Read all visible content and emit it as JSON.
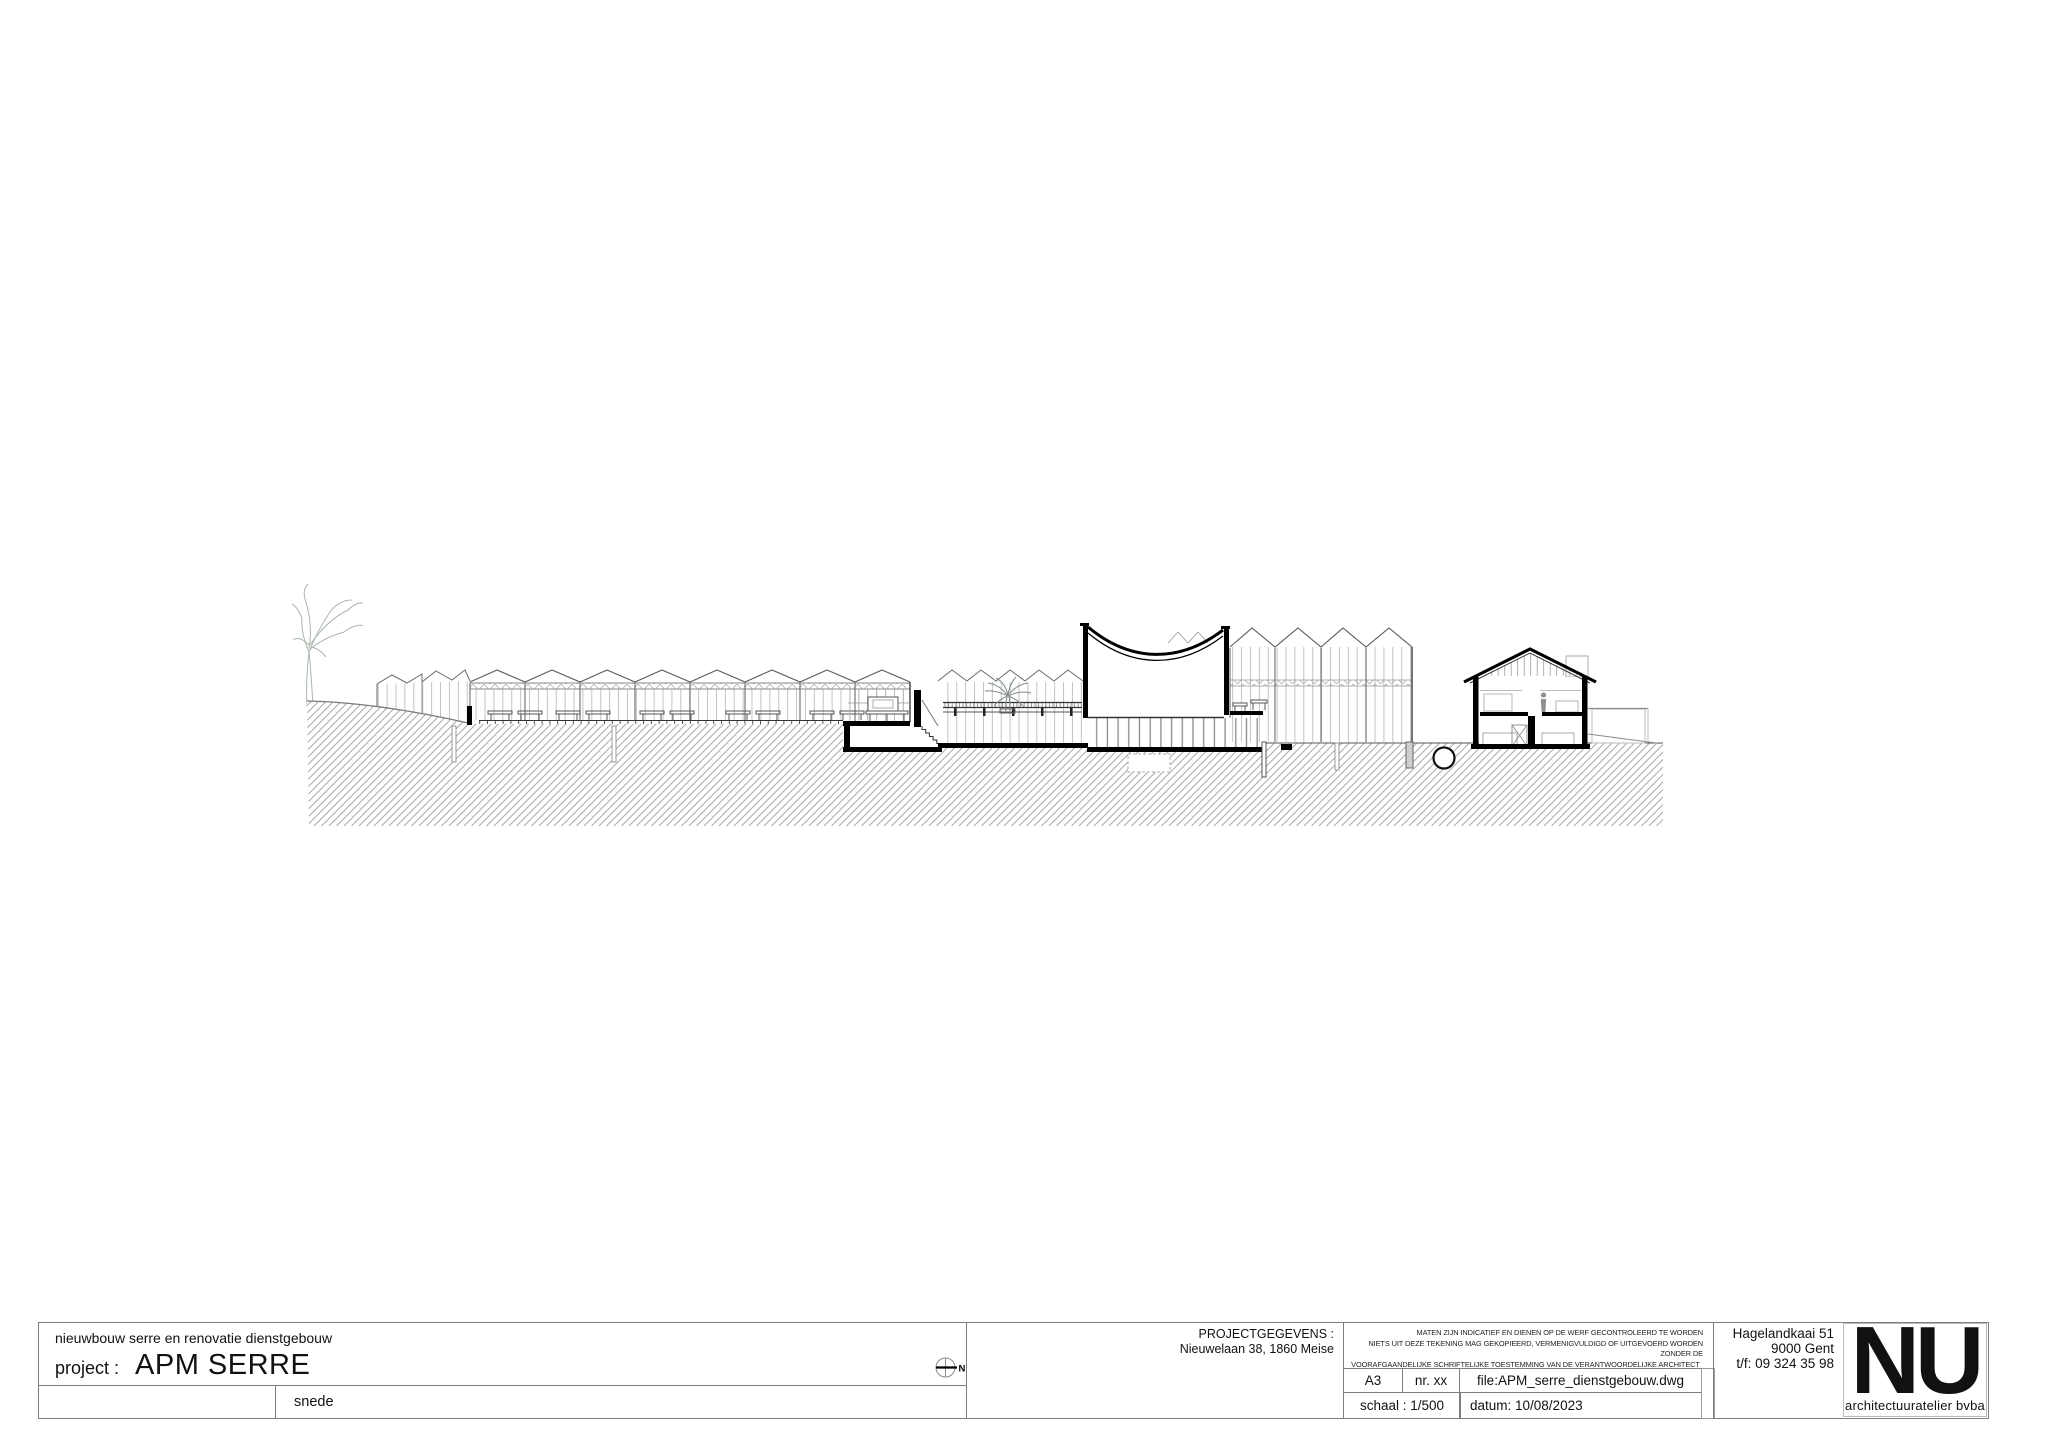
{
  "page": {
    "width": 2048,
    "height": 1448,
    "background": "#ffffff"
  },
  "drawing": {
    "kind": "architectural-section",
    "colors": {
      "cut_line": "#000000",
      "structure_line": "#6b6b6b",
      "glazing_line": "#b4b4b4",
      "hatch_line": "#9b9b9b",
      "tree": "#a9b7ad",
      "palm": "#7e8f84"
    }
  },
  "title_block": {
    "project_description": "nieuwbouw serre en renovatie dienstgebouw",
    "project_label": "project :",
    "project_name": "APM SERRE",
    "drawing_title": "snede",
    "north_label": "N",
    "project_data": {
      "label": "PROJECTGEGEVENS :",
      "address": "Nieuwelaan 38, 1860 Meise"
    },
    "disclaimer": {
      "line1": "MATEN ZIJN INDICATIEF EN DIENEN OP DE WERF GECONTROLEERD TE WORDEN",
      "line2": "NIETS UIT DEZE TEKENING MAG GEKOPIEERD, VERMENIGVULDIGD OF UITGEVOERD WORDEN ZONDER DE",
      "line3": "VOORAFGAANDELIJKE SCHRIFTELIJKE TOESTEMMING VAN DE VERANTWOORDELIJKE ARCHITECT"
    },
    "sheet": {
      "paper_size": "A3",
      "number": "nr. xx",
      "file": "file:APM_serre_dienstgebouw.dwg",
      "scale": "schaal : 1/500",
      "date": "datum: 10/08/2023"
    },
    "architect": {
      "address_line1": "Hagelandkaai 51",
      "address_line2": "9000 Gent",
      "phone": "t/f: 09 324 35 98",
      "logo_text": "NU",
      "logo_subtitle": "architectuuratelier bvba"
    }
  }
}
